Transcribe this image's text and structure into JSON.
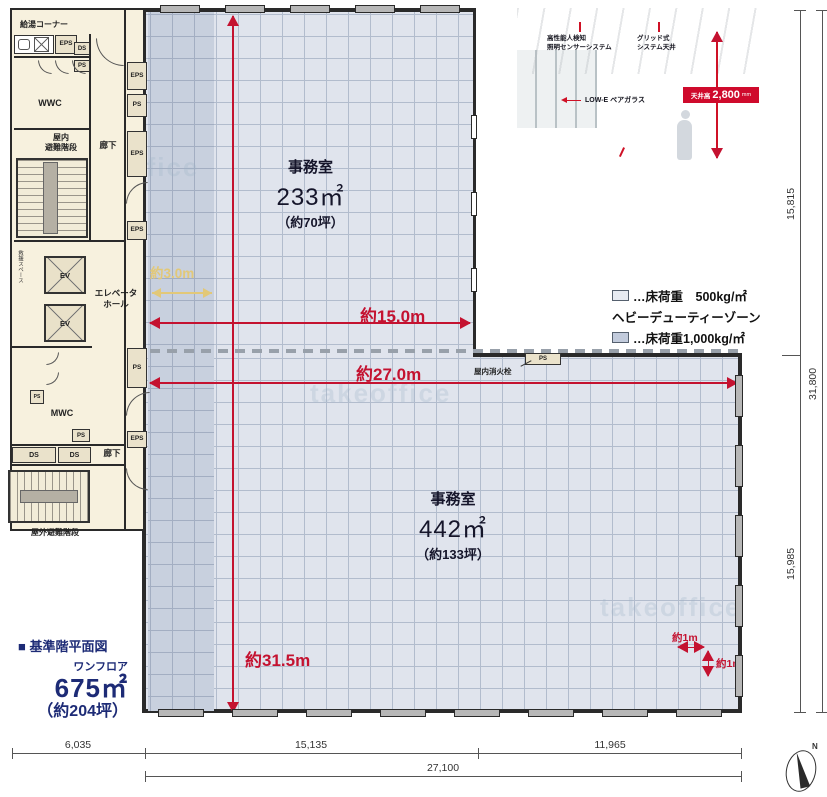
{
  "title_block": {
    "heading": "■ 基準階平面図",
    "floor_label": "ワンフロア",
    "area": "675㎡",
    "tsubo": "（約204坪）"
  },
  "rooms": {
    "upper": {
      "name": "事務室",
      "area": "233㎡",
      "tsubo": "（約70坪）"
    },
    "lower": {
      "name": "事務室",
      "area": "442㎡",
      "tsubo": "（約133坪）"
    }
  },
  "legend": {
    "light_label": "…床荷重　500kg/㎡",
    "heavy_title": "ヘビーデューティーゾーン",
    "heavy_label": "…床荷重1,000kg/㎡"
  },
  "dimensions": {
    "zone_width": "約3.0m",
    "upper_width": "約15.0m",
    "lower_width": "約27.0m",
    "depth": "約31.5m",
    "grid_w": "約1m",
    "grid_h": "約1m",
    "right_top": "15,815",
    "right_total": "31,800",
    "right_bottom": "15,985",
    "bottom_left": "6,035",
    "bottom_mid": "15,135",
    "bottom_right": "11,965",
    "bottom_total": "27,100"
  },
  "core": {
    "kitchen": "給湯コーナー",
    "wwc": "WWC",
    "mwc": "MWC",
    "stairs_l1": "屋内",
    "stairs_l2": "避難階段",
    "outdoor_stairs": "屋外避難階段",
    "corridor_upper": "廊下",
    "corridor_lower": "廊下",
    "ev_hall_l1": "エレベータ",
    "ev_hall_l2": "ホール",
    "ev": "EV",
    "rescue": "救援スペース",
    "eps": "EPS",
    "ps": "PS",
    "ds": "DS"
  },
  "fire_hydrant": {
    "label": "屋内消火栓",
    "chip": "PS"
  },
  "photo": {
    "sensor_line1": "高性能人検知",
    "sensor_line2": "照明センサーシステム",
    "grid_line1": "グリッド式",
    "grid_line2": "システム天井",
    "glass": "LOW-E ペアガラス",
    "ceiling_label": "天井高",
    "ceiling_value": "2,800",
    "ceiling_unit": "mm",
    "oa_label": "OAフロア",
    "oa_value": "100",
    "oa_unit": "mm"
  },
  "compass": {
    "label": "N"
  },
  "watermark": "takeoffice"
}
